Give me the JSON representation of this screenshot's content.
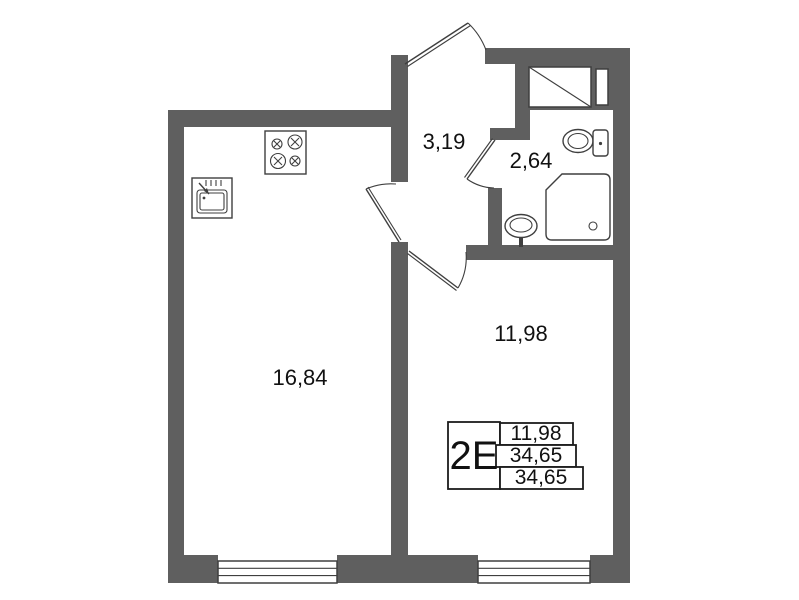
{
  "plan": {
    "rooms": {
      "kitchen_living": {
        "area": "16,84"
      },
      "hall": {
        "area": "3,19"
      },
      "bathroom": {
        "area": "2,64"
      },
      "room": {
        "area": "11,98"
      }
    },
    "stamp": {
      "type": "2E",
      "rows": [
        "11,98",
        "34,65",
        "34,65"
      ]
    },
    "colors": {
      "wall": "#5f5f5f",
      "line": "#3f3f3f",
      "text": "#111111",
      "bg": "#ffffff"
    }
  }
}
